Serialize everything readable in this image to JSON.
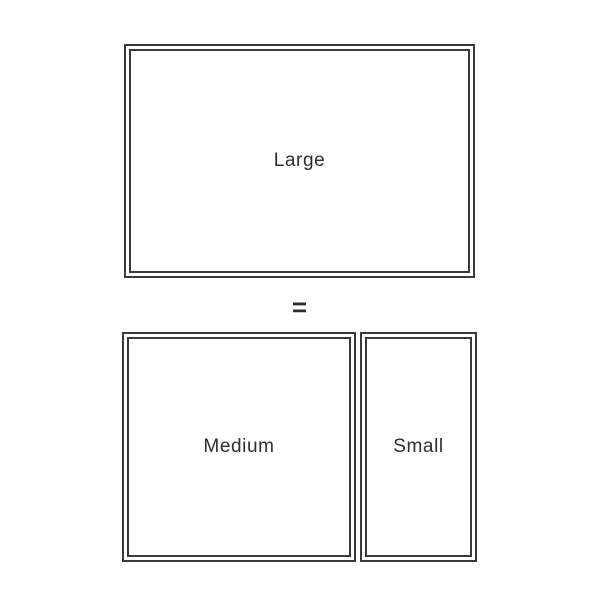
{
  "diagram": {
    "title": "rectangle-size-equivalence",
    "equals_sign": "=",
    "boxes": {
      "large": {
        "label": "Large"
      },
      "medium": {
        "label": "Medium"
      },
      "small": {
        "label": "Small"
      }
    },
    "colors": {
      "background": "#ffffff",
      "line": "#3a3a3a",
      "text": "#2e2e2e"
    }
  }
}
